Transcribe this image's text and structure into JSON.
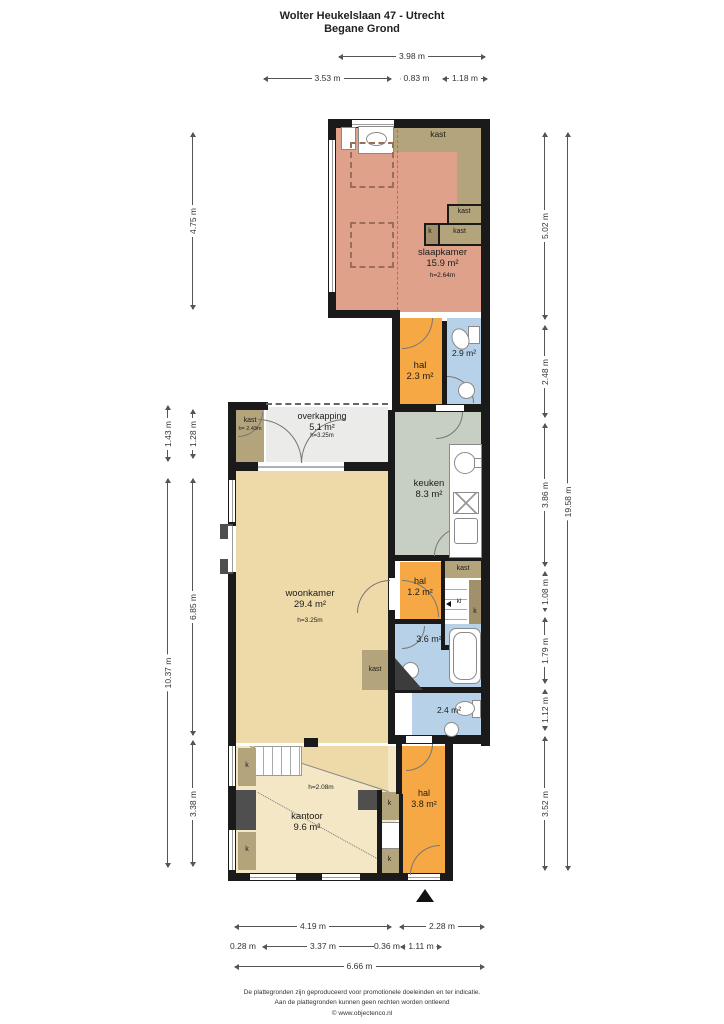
{
  "title": {
    "line1": "Wolter Heukelslaan 47 - Utrecht",
    "line2": "Begane Grond"
  },
  "rooms": {
    "slaapkamer": {
      "name": "slaapkamer",
      "area": "15.9 m²",
      "ceiling": "h=2.64m"
    },
    "hal_boven": {
      "name": "hal",
      "area": "2.3 m²"
    },
    "badkamer_boven": {
      "area": "2.9 m²"
    },
    "overkapping": {
      "name": "overkapping",
      "area": "5.1 m²",
      "ceiling": "h=3.25m"
    },
    "kast_tuin": {
      "name": "kast",
      "ceiling": "h= 2.43m"
    },
    "keuken": {
      "name": "keuken",
      "area": "8.3 m²"
    },
    "woonkamer": {
      "name": "woonkamer",
      "area": "29.4 m²",
      "ceiling": "h=3.25m"
    },
    "hal_midden": {
      "name": "hal",
      "area": "1.2 m²"
    },
    "badkamer_midden": {
      "area": "3.6 m²"
    },
    "toilet": {
      "area": "2.4 m²"
    },
    "kantoor": {
      "name": "kantoor",
      "area": "9.6 m²",
      "ceiling": "h=2.08m"
    },
    "hal_entree": {
      "name": "hal",
      "area": "3.8 m²"
    }
  },
  "labels": {
    "kast": "kast",
    "k": "k",
    "kl": "kl"
  },
  "dims": {
    "top1": "3.98 m",
    "top2": "3.53 m",
    "top3": "0.83 m",
    "top4": "1.18 m",
    "left1": "4.75 m",
    "left2": "1.43 m",
    "left3": "1.28 m",
    "left4": "10.37 m",
    "left5": "6.85 m",
    "left6": "3.38 m",
    "right1": "5.02 m",
    "right2": "2.48 m",
    "right3": "3.86 m",
    "right4": "1.08 m",
    "right5": "1.79 m",
    "right6": "1.12 m",
    "right7": "3.52 m",
    "right8": "19.58 m",
    "bottom1": "4.19 m",
    "bottom2": "2.28 m",
    "bottom3": "0.28 m",
    "bottom4": "3.37 m",
    "bottom5": "0.36 m",
    "bottom6": "1.11 m",
    "bottom7": "6.66 m"
  },
  "footer": {
    "line1": "De plattegronden zijn geproduceerd voor promotionele doeleinden en ter indicatie.",
    "line2": "Aan de plattegronden kunnen geen rechten worden ontleend",
    "line3": "© www.objectenco.nl"
  },
  "colors": {
    "wall": "#1a1a1a",
    "slaapkamer": "#dfa189",
    "hal": "#f5a844",
    "bad": "#b7d2e8",
    "keuken": "#c6cfc1",
    "woonkamer": "#eedaa9",
    "kantoor": "#f4e7c5",
    "overkapping": "#ebebe9",
    "kast": "#b3a47c",
    "kastdark": "#a1906a",
    "chimney": "#4f4f4f"
  }
}
